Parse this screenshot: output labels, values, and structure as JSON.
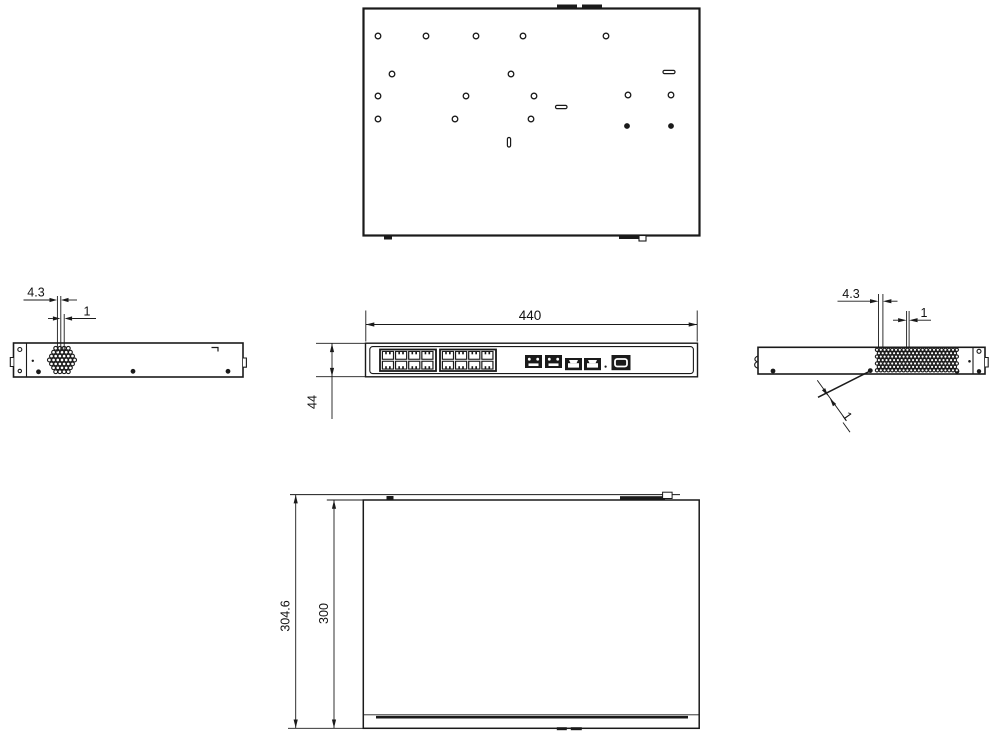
{
  "dimensions": {
    "front": {
      "width": "440",
      "height": "44"
    },
    "left_vent": {
      "pitch": "4.3",
      "hole": "1"
    },
    "right_vent": {
      "pitch": "4.3",
      "hole": "1",
      "wall": "1"
    },
    "bottom": {
      "overall_depth": "304.6",
      "body_depth": "300"
    }
  },
  "colors": {
    "line": "#1a1a1a",
    "background": "#ffffff"
  }
}
